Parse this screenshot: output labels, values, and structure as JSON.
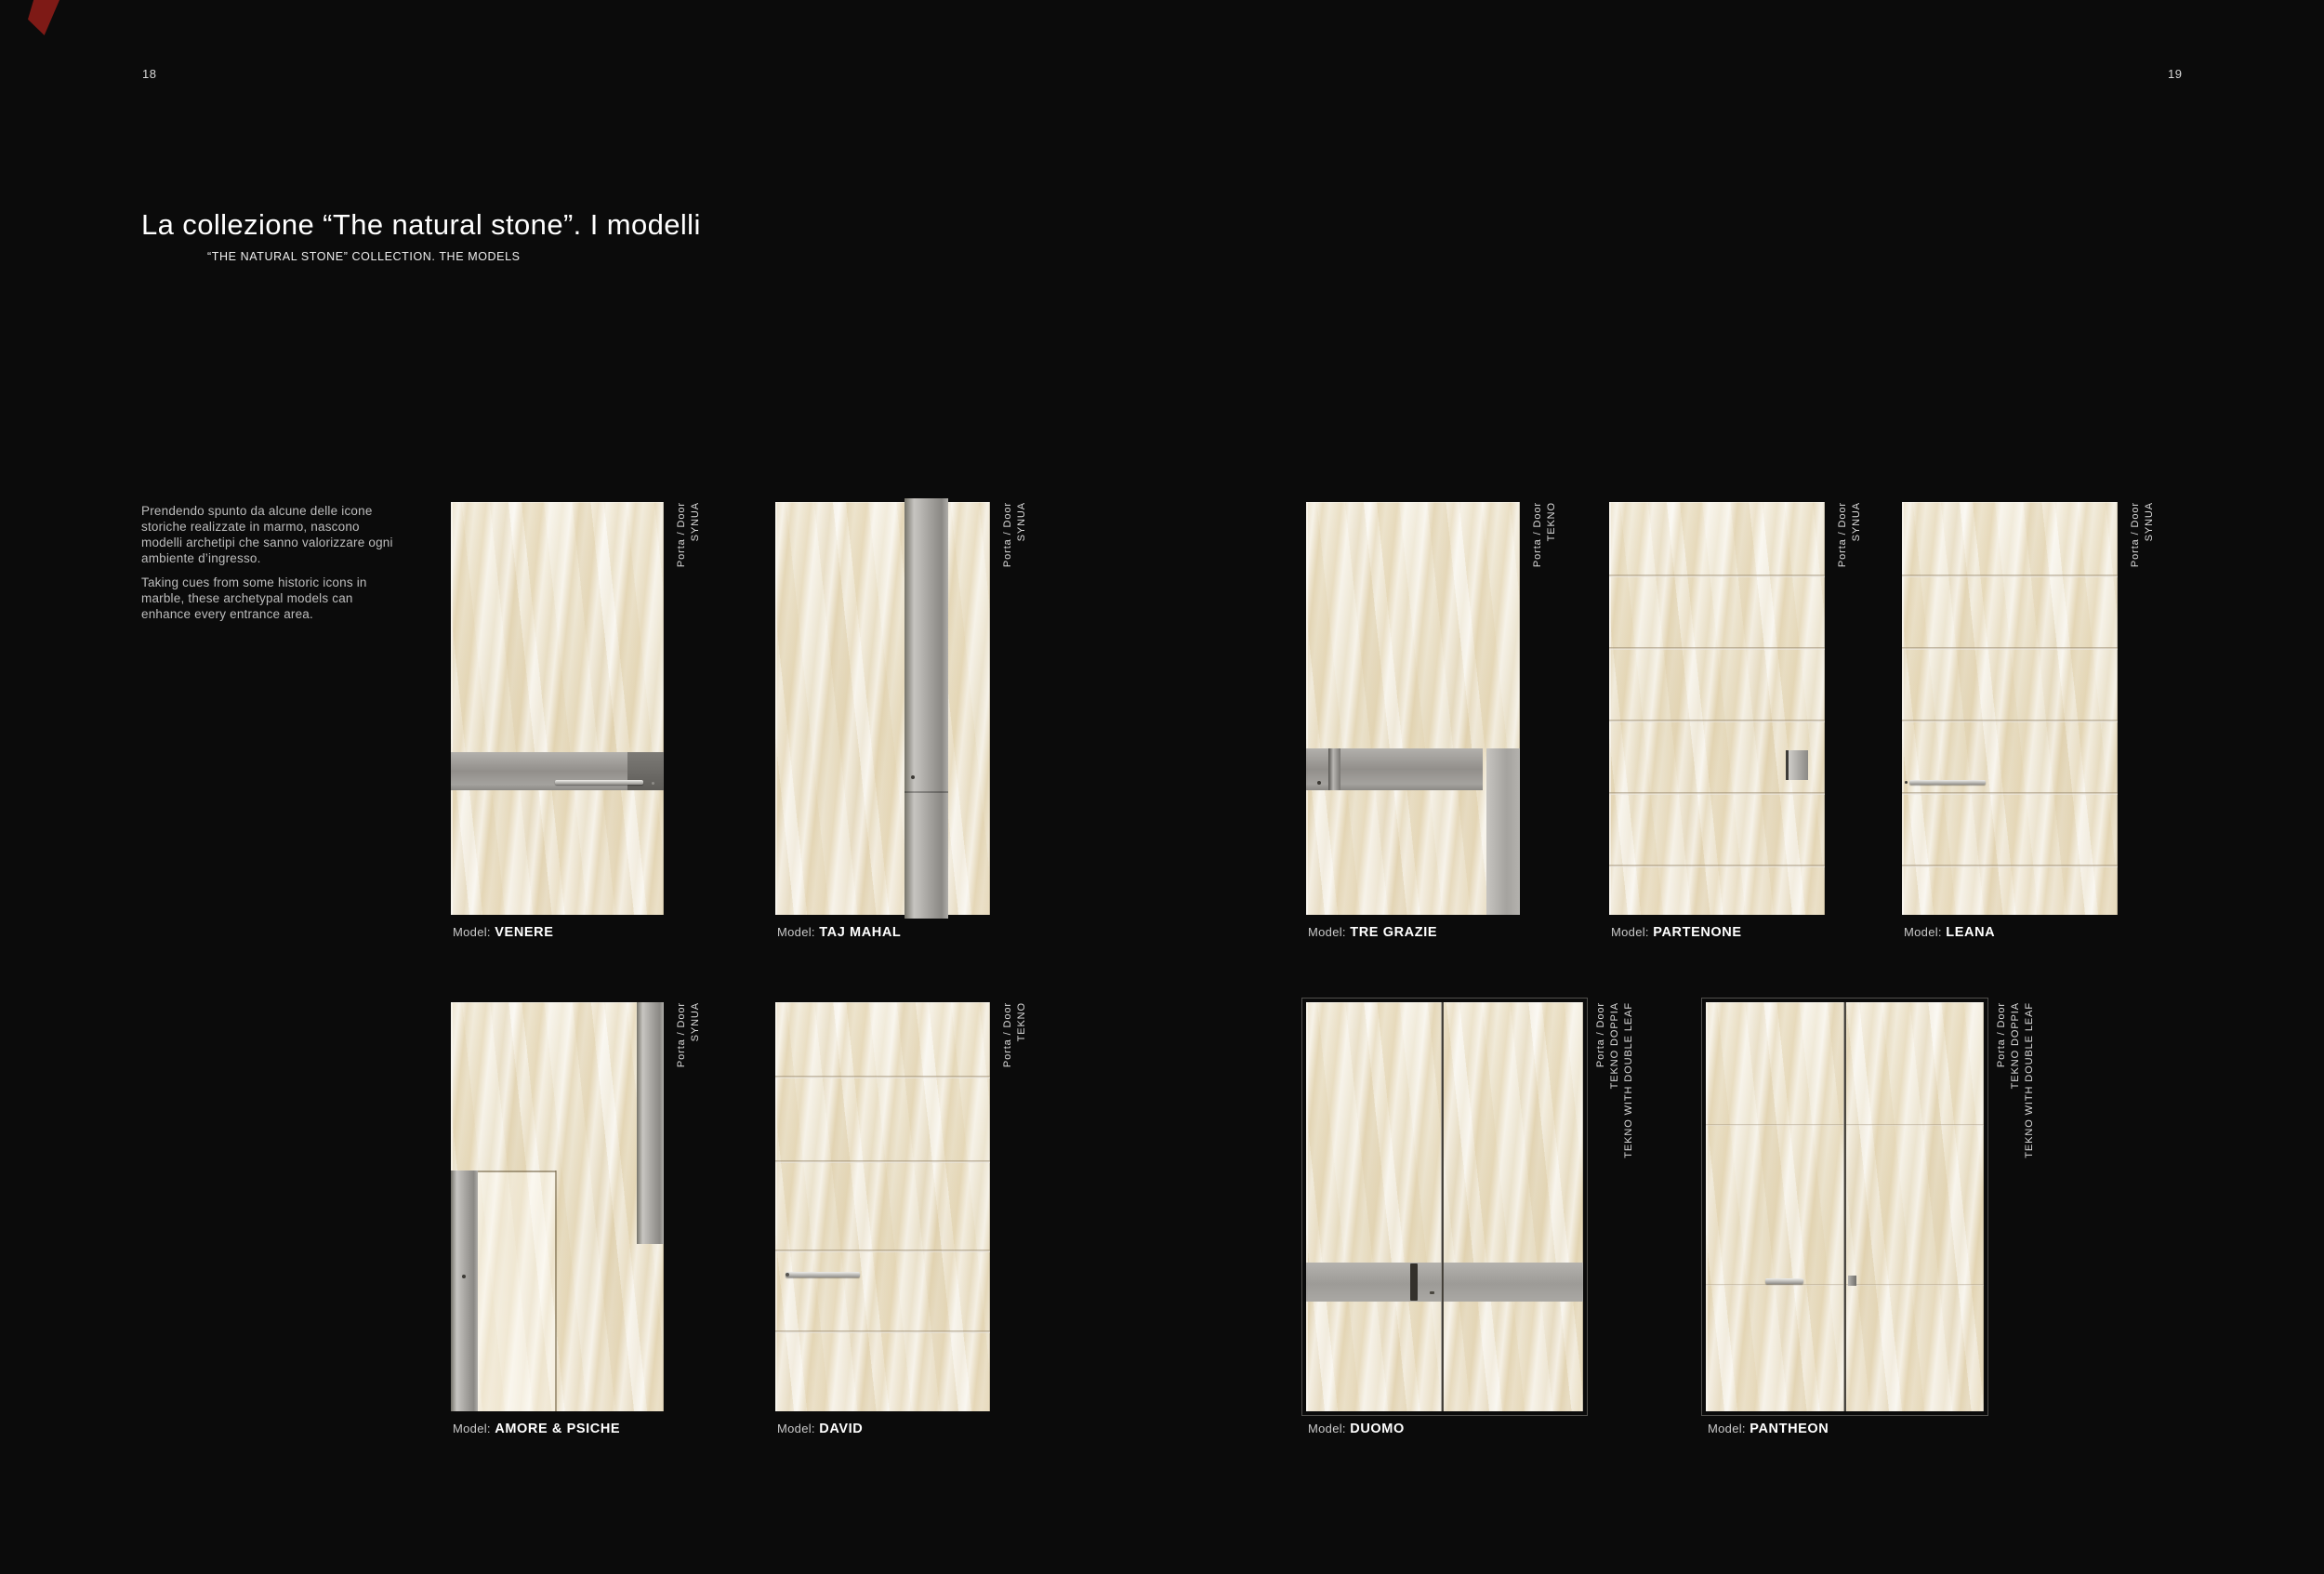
{
  "page": {
    "left_page_number": "18",
    "right_page_number": "19",
    "title": "La collezione “The natural stone”. I modelli",
    "subtitle": "“THE NATURAL STONE” COLLECTION. THE MODELS",
    "intro_paragraph_it": "Prendendo spunto da alcune delle icone storiche realizzate in marmo, nascono modelli archetipi che sanno valorizzare ogni ambiente d’ingresso.",
    "intro_paragraph_en": "Taking cues from some historic icons in marble, these archetypal models can enhance every entrance area.",
    "model_label_prefix": "Model:"
  },
  "doors": [
    {
      "model": "VENERE",
      "type_lines": [
        "Porta / Door",
        "SYNUA"
      ]
    },
    {
      "model": "TAJ MAHAL",
      "type_lines": [
        "Porta / Door",
        "SYNUA"
      ]
    },
    {
      "model": "TRE GRAZIE",
      "type_lines": [
        "Porta / Door",
        "TEKNO"
      ]
    },
    {
      "model": "PARTENONE",
      "type_lines": [
        "Porta / Door",
        "SYNUA"
      ]
    },
    {
      "model": "LEANA",
      "type_lines": [
        "Porta / Door",
        "SYNUA"
      ]
    },
    {
      "model": "AMORE & PSICHE",
      "type_lines": [
        "Porta / Door",
        "SYNUA"
      ]
    },
    {
      "model": "DAVID",
      "type_lines": [
        "Porta / Door",
        "TEKNO"
      ]
    },
    {
      "model": "DUOMO",
      "type_lines": [
        "Porta / Door",
        "TEKNO DOPPIA",
        "TEKNO WITH DOUBLE LEAF"
      ]
    },
    {
      "model": "PANTHEON",
      "type_lines": [
        "Porta / Door",
        "TEKNO DOPPIA",
        "TEKNO WITH DOUBLE LEAF"
      ]
    }
  ],
  "colors": {
    "background": "#0b0b0b",
    "text_primary": "#ffffff",
    "text_secondary": "#bdbdbd",
    "marble_base": "#ebe2cd",
    "steel": "#9c9a96",
    "accent_corner_red": "#7e1a16"
  }
}
